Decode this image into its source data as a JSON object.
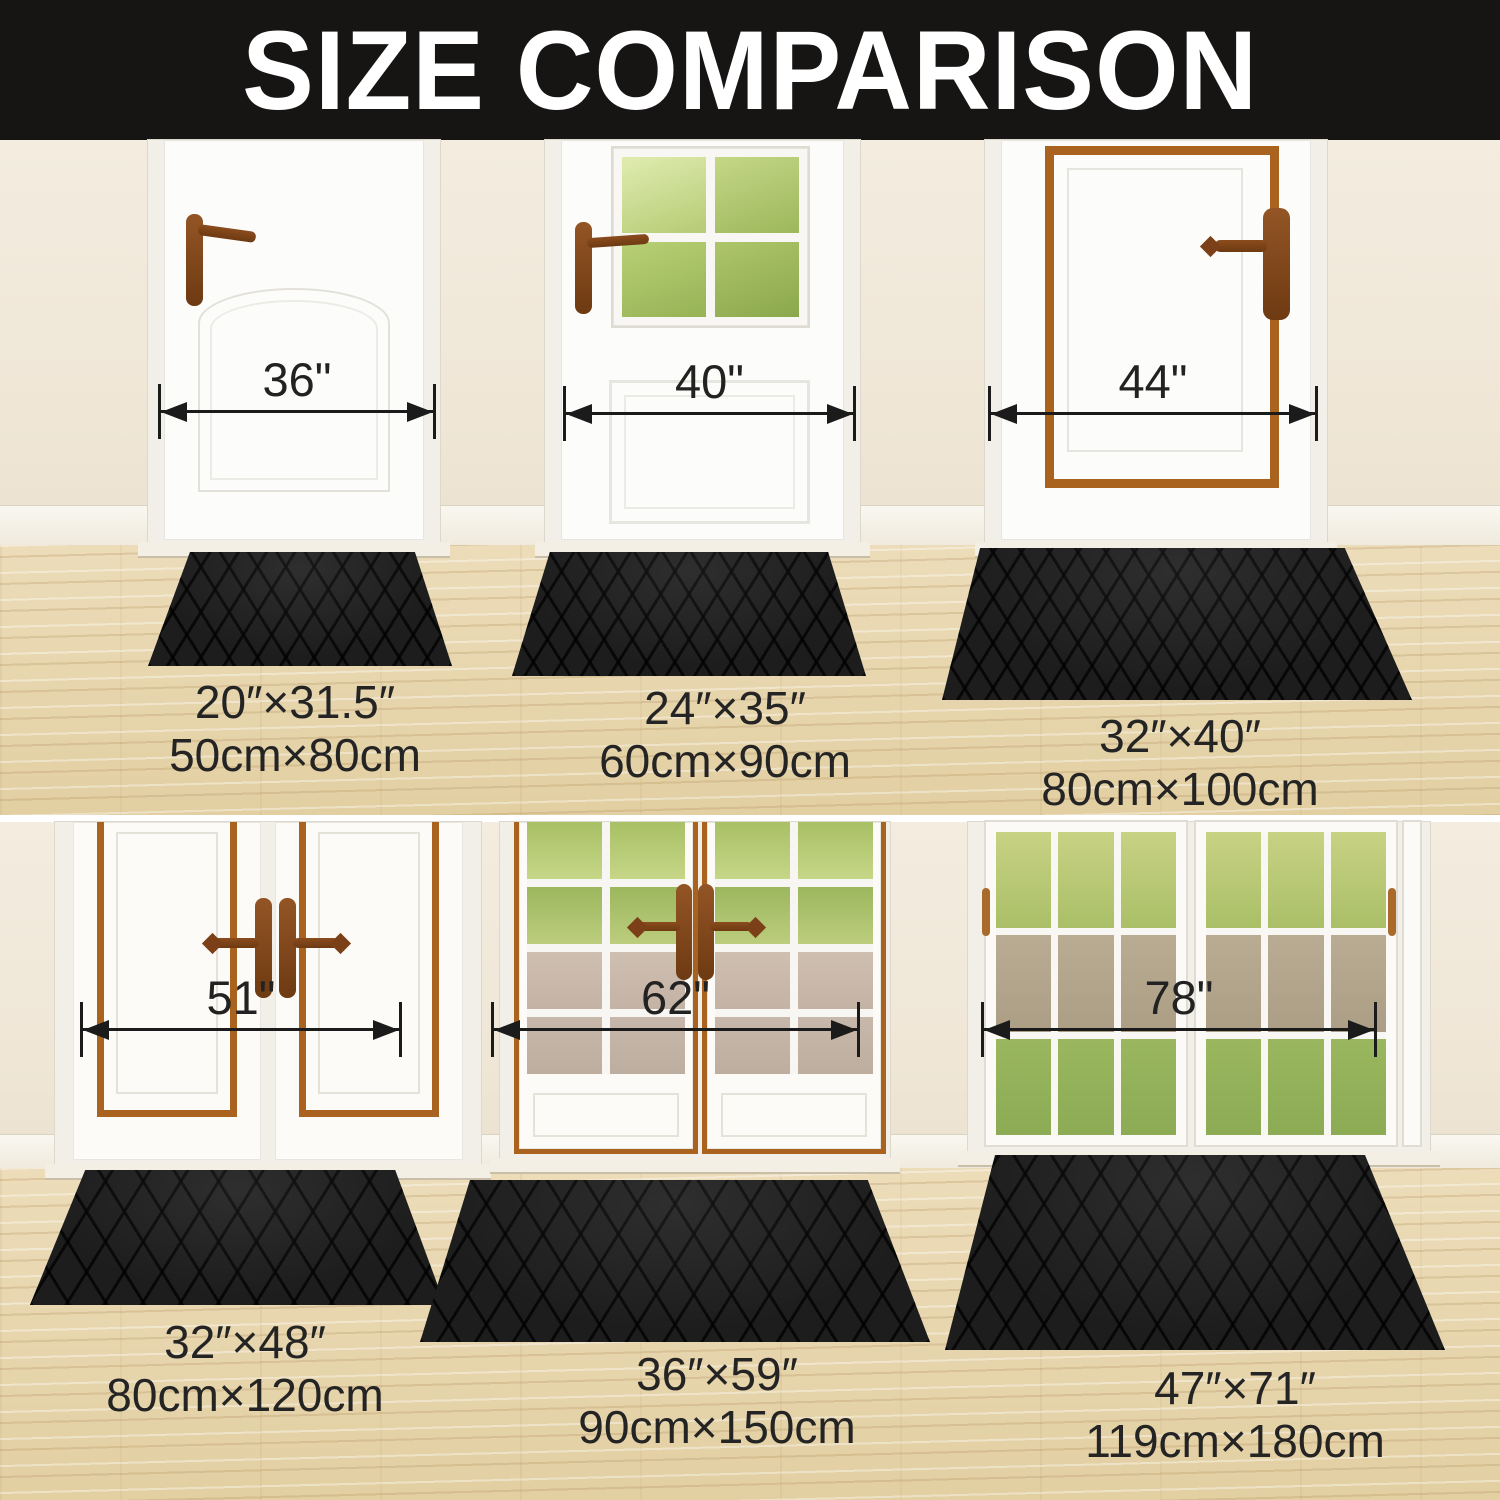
{
  "title": "SIZE COMPARISON",
  "top_row": {
    "doors": [
      {
        "width_label": "36\""
      },
      {
        "width_label": "40\""
      },
      {
        "width_label": "44\""
      }
    ],
    "mats": [
      {
        "inches": "20″×31.5″",
        "cm": "50cm×80cm"
      },
      {
        "inches": "24″×35″",
        "cm": "60cm×90cm"
      },
      {
        "inches": "32″×40″",
        "cm": "80cm×100cm"
      }
    ]
  },
  "bottom_row": {
    "doors": [
      {
        "width_label": "51\""
      },
      {
        "width_label": "62\""
      },
      {
        "width_label": "78\""
      }
    ],
    "mats": [
      {
        "inches": "32″×48″",
        "cm": "80cm×120cm"
      },
      {
        "inches": "36″×59″",
        "cm": "90cm×150cm"
      },
      {
        "inches": "47″×71″",
        "cm": "119cm×180cm"
      }
    ]
  },
  "colors": {
    "banner": "#171414",
    "banner_text": "#ffffff",
    "wall": "#f0e8da",
    "floor_wood": "#e7d6af",
    "mat": "#1d1d1d",
    "copper_trim": "#a9631f",
    "measure_line": "#1b1b1b",
    "caption_text": "#242424"
  }
}
